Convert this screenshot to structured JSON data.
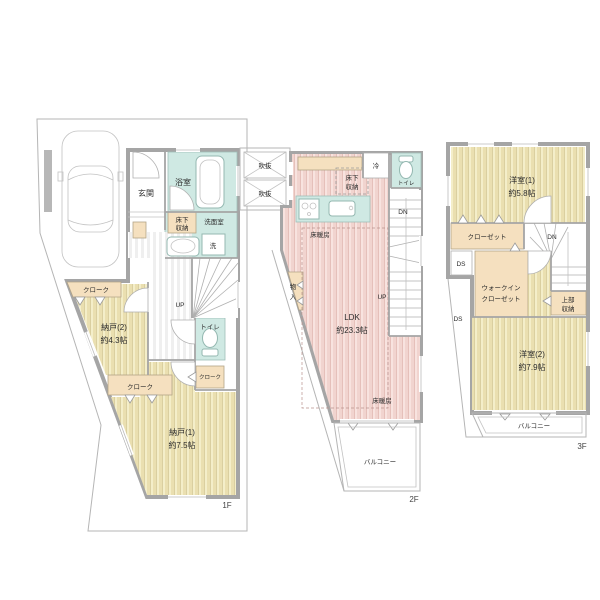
{
  "title": "戸建て間取り図（1F・2F・3F）",
  "colors": {
    "wall": "#a5a5a5",
    "wood_light": "#f4eec9",
    "wood_dark": "#eadfb0",
    "pink_light": "#f8e3df",
    "pink_dark": "#f1d4cf",
    "teal": "#cfe9e3",
    "closet_beige": "#f5e0bf",
    "lot_line": "#b5b5b5",
    "text": "#2b2b2b"
  },
  "f1": {
    "tag": "1F",
    "genkan": "玄関",
    "bath": "浴室",
    "yukashita_l1": "床下",
    "yukashita_l2": "収納",
    "senmen": "洗面室",
    "wash": "洗",
    "cloak_a": "クローク",
    "cloak_b": "クローク",
    "cloak_c": "クローク",
    "nando2": "納戸(2)",
    "nando2_size": "約4.3帖",
    "toilet": "トイレ",
    "up": "UP",
    "nando1": "納戸(1)",
    "nando1_size": "約7.5帖"
  },
  "f2": {
    "tag": "2F",
    "void1": "吹抜",
    "void2": "吹抜",
    "yukashita_l1": "床下",
    "yukashita_l2": "収納",
    "fridge": "冷",
    "toilet": "トイレ",
    "dn": "DN",
    "up": "UP",
    "floorheat_a": "床暖房",
    "floorheat_b": "床暖房",
    "mono_l1": "物",
    "mono_l2": "入",
    "ldk": "LDK",
    "ldk_size": "約23.3帖",
    "balcony": "バルコニー"
  },
  "f3": {
    "tag": "3F",
    "yoshitsu1": "洋室(1)",
    "yoshitsu1_size": "約5.8帖",
    "closet": "クローゼット",
    "dn": "DN",
    "ds_a": "DS",
    "ds_b": "DS",
    "wic_l1": "ウォークイン",
    "wic_l2": "クローゼット",
    "joubu_l1": "上部",
    "joubu_l2": "収納",
    "yoshitsu2": "洋室(2)",
    "yoshitsu2_size": "約7.9帖",
    "balcony": "バルコニー"
  }
}
